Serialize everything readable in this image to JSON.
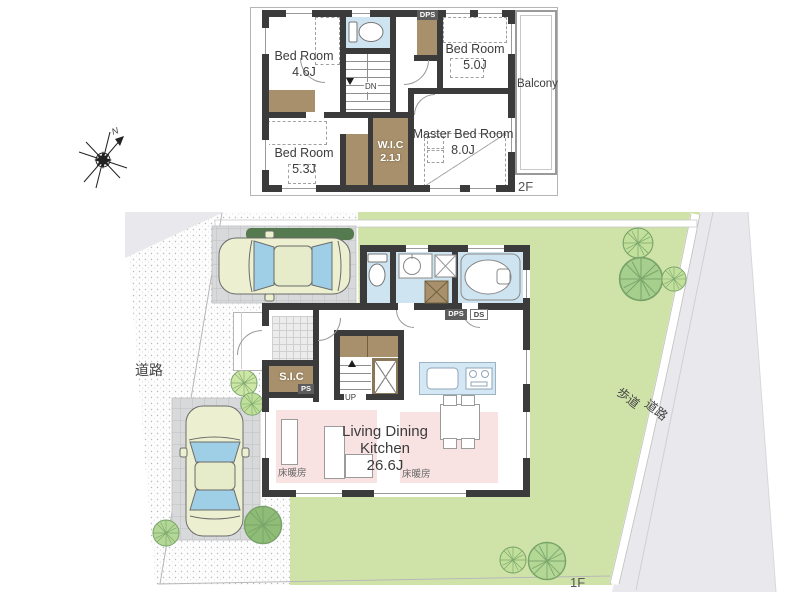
{
  "floor2": {
    "label": "2F",
    "bedroom_a": {
      "name": "Bed Room",
      "size": "4.6J"
    },
    "bedroom_b": {
      "name": "Bed Room",
      "size": "5.0J"
    },
    "bedroom_c": {
      "name": "Bed Room",
      "size": "5.3J"
    },
    "master_bedroom": {
      "name": "Master Bed Room",
      "size": "8.0J"
    },
    "wic": {
      "name": "W.I.C",
      "size": "2.1J"
    },
    "balcony_label": "Balcony",
    "dn_label": "DN",
    "dps_label": "DPS"
  },
  "floor1": {
    "label": "1F",
    "ldk": {
      "line1": "Living Dining",
      "line2": "Kitchen",
      "size": "26.6J"
    },
    "floor_heating_left": "床暖房",
    "floor_heating_right": "床暖房",
    "sic_label": "S.I.C",
    "ps_label": "PS",
    "up_label": "UP",
    "dps_label": "DPS",
    "ds_label": "DS"
  },
  "site": {
    "road_left_label": "道路",
    "sidewalk_label": "歩道",
    "road_right_label": "道路",
    "compass_north": "N"
  },
  "colors": {
    "wall": "#3b3b3b",
    "closet_brown": "#a8906c",
    "wet_blue": "#cfe4f1",
    "heated_pink": "#f8e2e2",
    "garden_green": "#cfe3a9",
    "tree_green": "#b3d795",
    "road_gray": "#e9e9ed",
    "tile_gray": "#d8d9da",
    "car_body": "#edf0d0",
    "car_glass": "#9fcfe6"
  }
}
